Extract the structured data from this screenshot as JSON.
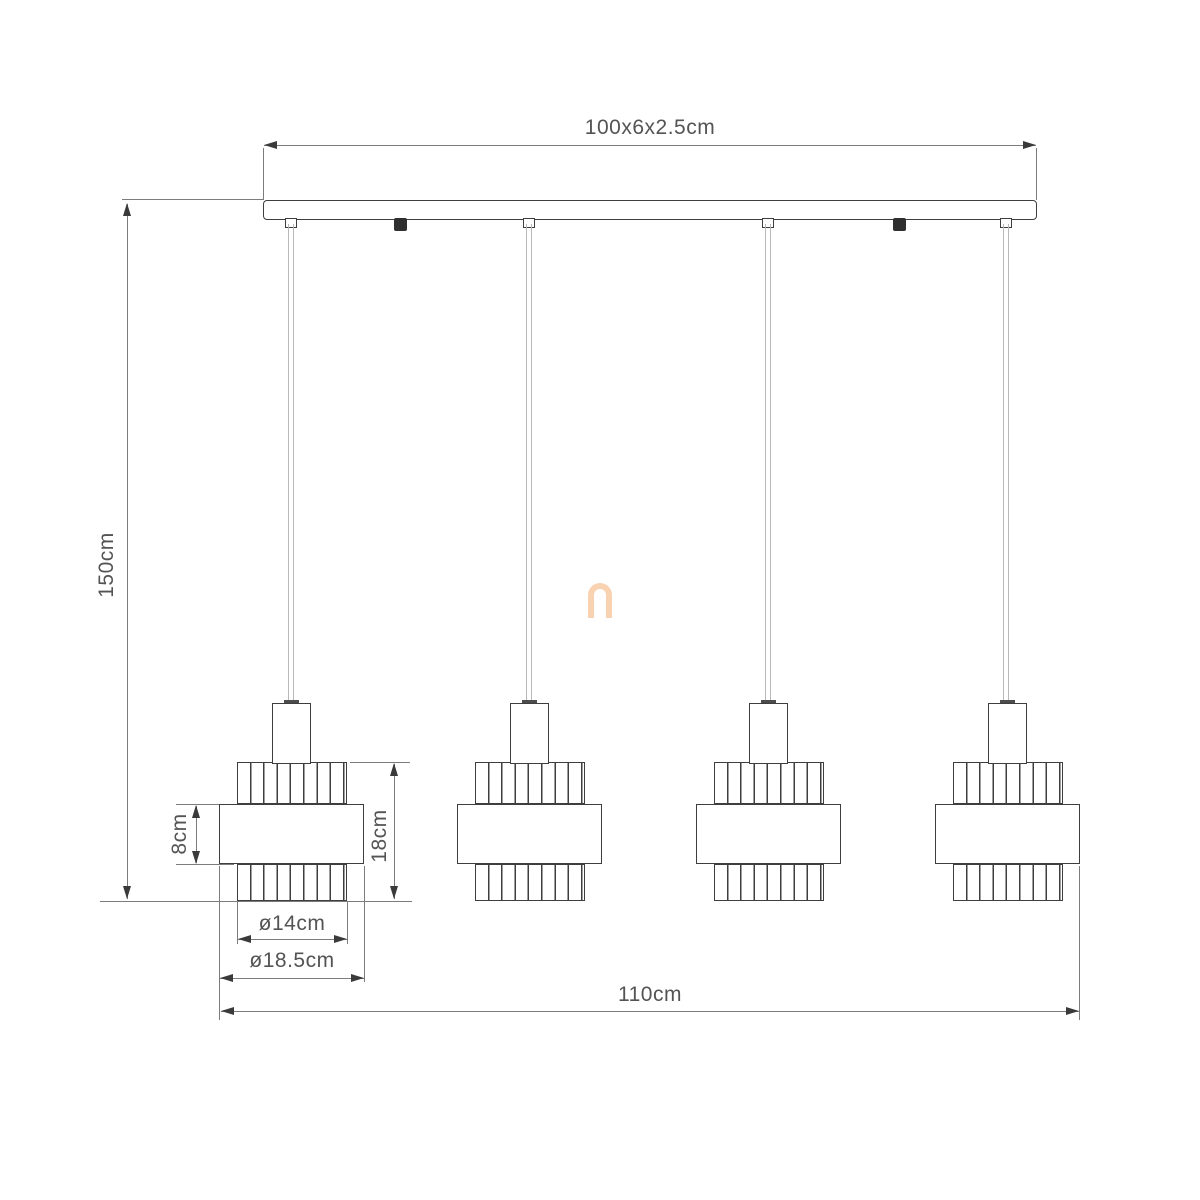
{
  "diagram": {
    "kind": "technical-dimension-drawing",
    "subject": "4-light linear pendant lamp",
    "lamp_count": 4,
    "labels": {
      "canopy_size": "100x6x2.5cm",
      "drop_height": "150cm",
      "band_height": "8cm",
      "shade_height": "18cm",
      "top_diameter": "ø14cm",
      "band_diameter": "ø18.5cm",
      "overall_width": "110cm"
    },
    "watermark_glyph": "n",
    "colors": {
      "outline": "#3e3e3e",
      "dimension_line": "#7c7c7c",
      "text": "#545454",
      "cord": "#b9b9b9",
      "watermark": "#f9d2b2",
      "background": "#ffffff"
    }
  }
}
